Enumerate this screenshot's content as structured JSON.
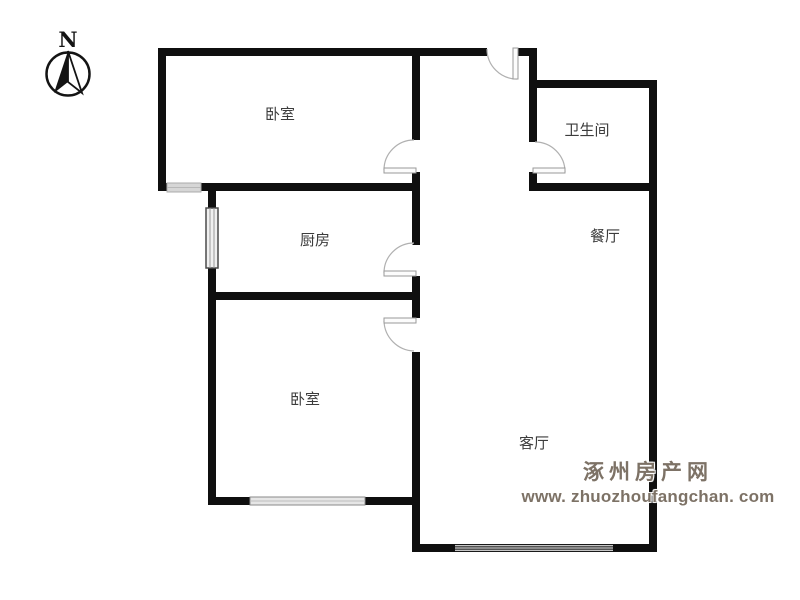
{
  "compass": {
    "label": "N"
  },
  "rooms": [
    {
      "id": "bedroom-top",
      "label": "卧室"
    },
    {
      "id": "bathroom",
      "label": "卫生间"
    },
    {
      "id": "dining",
      "label": "餐厅"
    },
    {
      "id": "kitchen",
      "label": "厨房"
    },
    {
      "id": "bedroom-bottom",
      "label": "卧室"
    },
    {
      "id": "living",
      "label": "客厅"
    }
  ],
  "watermark": {
    "site_name": "涿州房产网",
    "site_url": "www. zhuozhoufangchan. com"
  },
  "colors": {
    "background": "#ffffff",
    "wall": "#0f0f0f",
    "door_arc": "#b0b0b0",
    "door_leaf_stroke": "#999999",
    "label_text": "#3c3c3c",
    "watermark_text": "#7d7266"
  }
}
